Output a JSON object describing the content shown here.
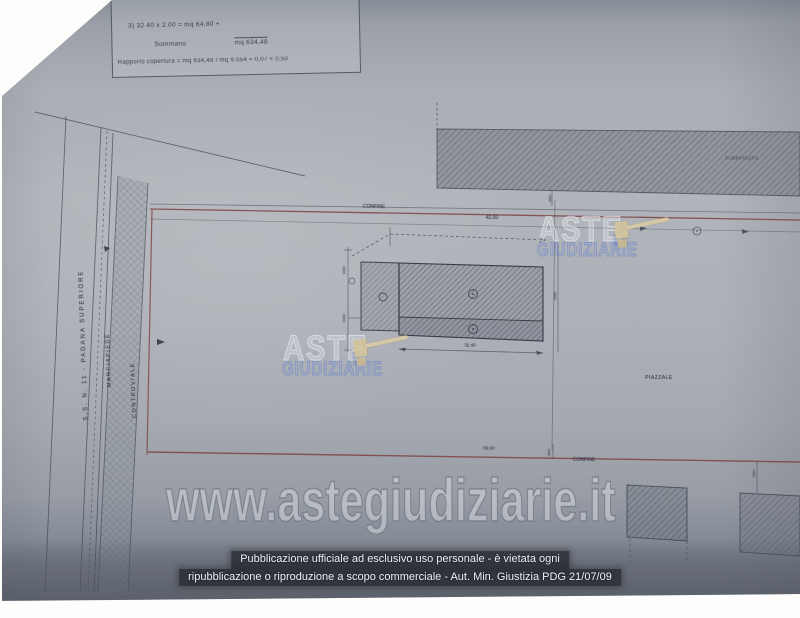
{
  "computation_table": {
    "row1": "3)   32.40 x   2.00    =   mq       64,80 +",
    "row2_label": "Sommano",
    "row2_value": "mq   634,48",
    "row3": "Rapporto copertura = mq 634,48 / mq 9.554 = 0,07 < 0,50"
  },
  "plan": {
    "road_label": "S.S. N. 11  -  PADANA  SUPERIORE",
    "sidewalk_label": "MARCIAPIEDE",
    "service_road_label": "CONTROVIALE",
    "boundary_top_label": "CONFINE",
    "boundary_top_dim": "42.00",
    "building_width_dim": "32.40",
    "boundary_bottom_dim": "59.60",
    "boundary_bottom_label": "CONFINE",
    "yard_label": "PIAZZALE",
    "adjacent_building_label": "FABBRICATO"
  },
  "watermark": {
    "brand_top": "ASTE",
    "brand_bottom": "GIUDIZIARIE",
    "url": "www.astegiudiziarie.it"
  },
  "footer": {
    "line1": "Pubblicazione ufficiale ad esclusivo uso personale - è vietata ogni",
    "line2": "ripubblicazione o riproduzione a scopo commerciale - Aut. Min. Giustizia PDG 21/07/09"
  },
  "colors": {
    "boundary_red": "#7d4343",
    "drawing_ink": "#454b56",
    "brand_blue": "#5b7bd0",
    "gavel_tan": "#d3c49d",
    "footer_bar": "#26292f"
  }
}
